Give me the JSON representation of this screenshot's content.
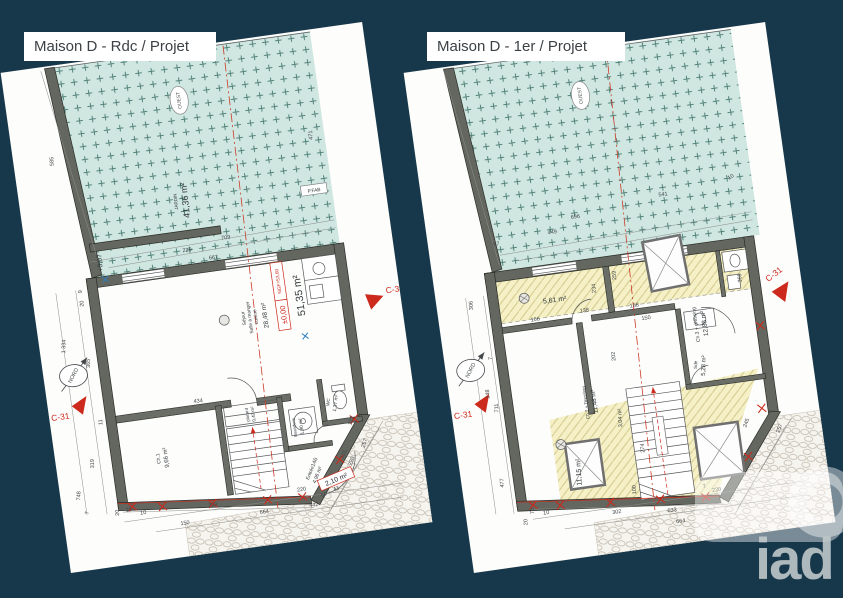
{
  "page": {
    "background": "#17384a"
  },
  "watermark": {
    "brand": "iad"
  },
  "panels": [
    {
      "title": "Maison D - Rdc / Projet",
      "markers": {
        "section": "C-31",
        "north": "NORD",
        "west": "OUEST"
      },
      "garden": {
        "label": "JARDIN",
        "area": "41,36 m²",
        "level": "+0,07"
      },
      "main_room": {
        "lines": [
          "Séjour",
          "Salle à manger",
          "cuisine"
        ],
        "area": "28,48 m²"
      },
      "level_box": {
        "value": "±0,00",
        "ngf": "NGF=53,60"
      },
      "total_area": "51,35 m²",
      "tag_box": "P.FAB",
      "exterior_area": "2,10 m²",
      "rooms": [
        {
          "name": "Ch.1",
          "area": "9,66 m²"
        },
        {
          "name": "placard",
          "area": "0,49 m²"
        },
        {
          "name": "Buanderie",
          "area": "1,90 m²"
        },
        {
          "name": "WC",
          "area": "1,37 m²"
        },
        {
          "name": "Entrée",
          "area": "4,96 m²"
        }
      ],
      "dimensions": [
        "585",
        "471",
        "709",
        "229",
        "667",
        "9",
        "20",
        "1 334",
        "365",
        "319",
        "11",
        "748",
        "7",
        "434",
        "10",
        "299",
        "150",
        "664",
        "442",
        "220",
        "146",
        "101",
        "220",
        "257",
        "123",
        "66",
        "41",
        "20",
        "10"
      ]
    },
    {
      "title": "Maison D - 1er / Projet",
      "markers": {
        "section": "C-31",
        "north": "NORD",
        "west": "OUEST"
      },
      "rooms": [
        {
          "name": "Ch.3 + dressing",
          "area": "12,88 m²"
        },
        {
          "name": "Ch.2 + Dressing",
          "area": "11,48 m²"
        },
        {
          "name": "Sde",
          "area": "5,28 m²"
        },
        {
          "name": "",
          "area": "5,61 m²"
        },
        {
          "name": "",
          "area": "11,15 m²"
        },
        {
          "name": "",
          "area": "3,04 m²"
        }
      ],
      "dimensions": [
        "10",
        "541",
        "696",
        "449",
        "67",
        "306",
        "148",
        "711",
        "477",
        "7",
        "234",
        "259",
        "158",
        "166",
        "138",
        "150",
        "369",
        "202",
        "274",
        "100",
        "245",
        "257",
        "20",
        "70",
        "10",
        "302",
        "633",
        "664",
        "220",
        "7"
      ]
    }
  ]
}
